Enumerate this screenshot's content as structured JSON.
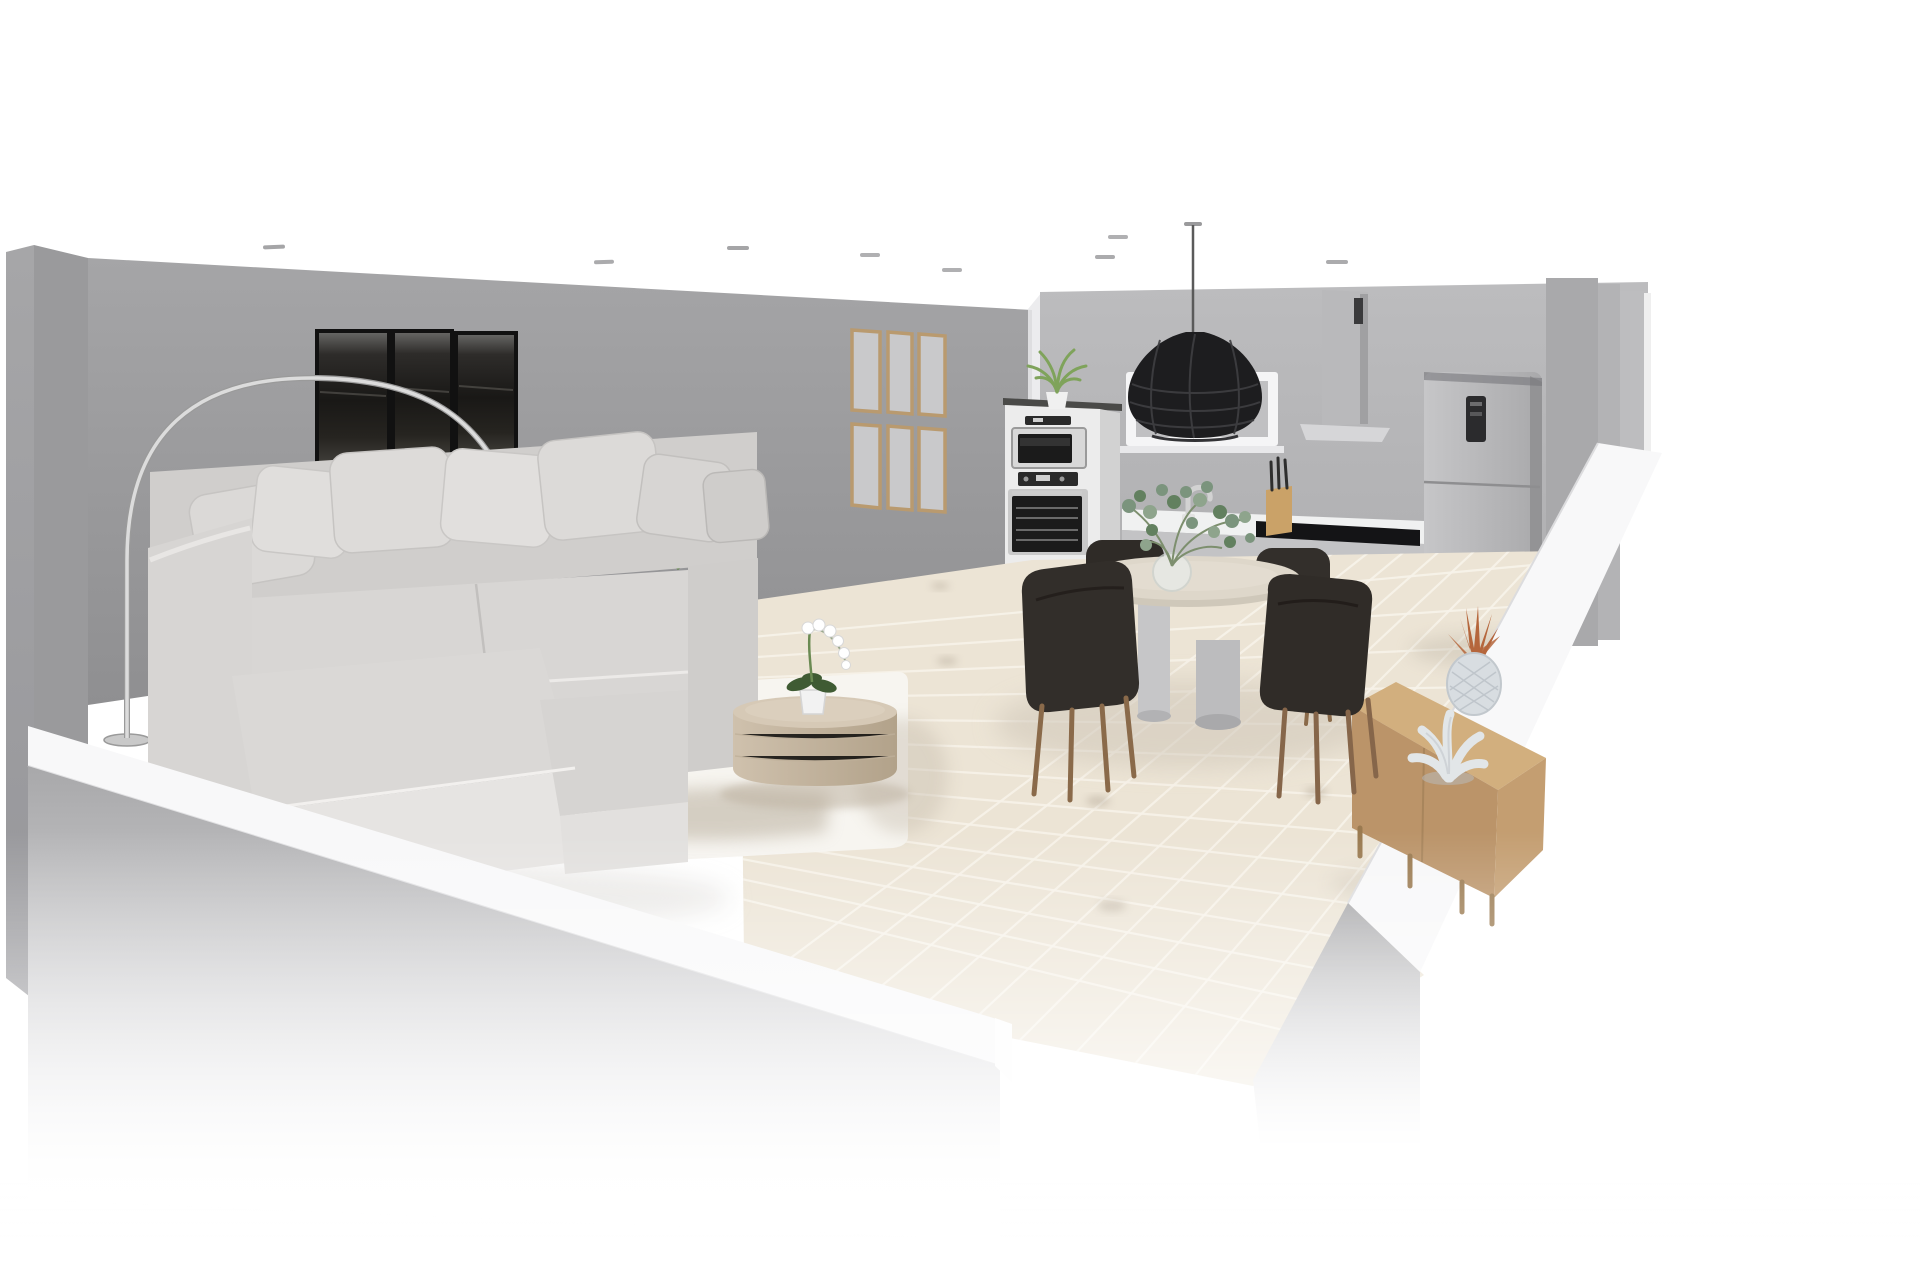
{
  "scene": {
    "type": "3d-interior-cutaway-render",
    "description": "Cutaway 3D rendering of an open-plan living room and kitchen-dining area, viewed from an elevated front-left angle. Gray walls, beige tiled floor, white fog fade at the bottom edges, and recessed ceiling spotlights.",
    "rooms": [
      {
        "name": "living-room",
        "objects": [
          "sectional-sofa",
          "throw-pillows",
          "arc-floor-lamp",
          "triptych-wall-art",
          "palm-plant",
          "area-rug",
          "round-coffee-table",
          "potted-orchid"
        ]
      },
      {
        "name": "kitchen-dining",
        "objects": [
          "gallery-frame-grid",
          "wall-window-frame",
          "wicker-pendant-lamp",
          "tall-oven-cabinet",
          "microwave",
          "oven",
          "cabinet-top-plant",
          "kitchen-counter",
          "cooktop",
          "faucet",
          "knife-block",
          "range-hood",
          "fridge-freezer",
          "round-dining-table",
          "dining-chairs",
          "eucalyptus-centerpiece",
          "wood-sideboard",
          "pineapple-ornament",
          "coral-ornament"
        ]
      }
    ],
    "lighting": {
      "ceiling_spotlights": 8,
      "pendant_over_dining": 1,
      "arc_lamp": 1
    }
  },
  "counts": {
    "dining_chairs": 4,
    "art_panels": 3,
    "gallery_frames": 6,
    "sofa_pillows": 7
  },
  "colors": {
    "background": "#ffffff",
    "wall_left": "#a0a0a2",
    "wall_back_top": "#a5a5a7",
    "wall_back_bottom": "#8f8f91",
    "wall_kitchen_top": "#bcbcbe",
    "wall_kitchen_bottom": "#a2a2a4",
    "wall_cut_white": "#f8f8f9",
    "floor_tile": "#ece4d5",
    "grout": "#f8f3ea",
    "rug": "#f7f5f0",
    "rug_shadow": "#b3a896",
    "sofa_body": "#d5d3d1",
    "sofa_light": "#e2e0de",
    "pillow": "#dbd9d7",
    "art_frame": "#111111",
    "gallery_frame_wood": "#b99a6f",
    "coffee_table_top": "#d6c9b6",
    "coffee_table_side": "#c4b59f",
    "dining_table_top": "#ded7ca",
    "dining_table_edge": "#cfc8ba",
    "pedestal_gray": "#c6c6c8",
    "chair_dark": "#322e2a",
    "chair_leg_wood": "#8a6a4a",
    "pendant_black": "#1d1d1f",
    "cord_gray": "#5a5a5a",
    "oven_cabinet": "#ececec",
    "appliance_dark": "#1b1b1b",
    "appliance_silver": "#d8d8d8",
    "countertop": "#f0f1f1",
    "counter_front": "#c3c3c5",
    "cooktop_black": "#141416",
    "knife_block_wood": "#caa268",
    "hood_gray": "#b9b9bb",
    "fridge_gray": "#b7b7b9",
    "sideboard_top": "#d2af7e",
    "sideboard_front": "#bb9469",
    "pineapple_body": "#d8dde1",
    "pineapple_leaves": "#b5663c",
    "coral_white": "#e2e6e8",
    "plant_green": "#6d9a4f",
    "plant_green_dark": "#557f3a",
    "eucalyptus_green": "#7b947d",
    "orchid_white": "#ffffff",
    "lamp_metal": "#dcdcdc",
    "spotlight_gray": "#8f8f91",
    "shadow_soft": "#cfc6b8"
  },
  "objects": {
    "sofa": {
      "label": "Light gray sectional sofa with chaise and throw pillows"
    },
    "arc_lamp": {
      "label": "Chrome arc floor lamp with glass globe shade"
    },
    "art": {
      "label": "Three-panel dark abstract wall art"
    },
    "gallery": {
      "label": "Grid of six empty wooden picture frames"
    },
    "palm": {
      "label": "Green palm houseplant behind sofa"
    },
    "rug": {
      "label": "White area rug"
    },
    "coffee_table": {
      "label": "Round wooden drum coffee table"
    },
    "orchid": {
      "label": "White orchid in a pot"
    },
    "pendant": {
      "label": "Black woven pendant lamp over dining table"
    },
    "window": {
      "label": "White wall frame / window above counter"
    },
    "oven_column": {
      "label": "Tall cabinet with built-in microwave and oven"
    },
    "cabinet_plant": {
      "label": "Small plant on top of oven cabinet"
    },
    "counter": {
      "label": "Kitchen counter with sink and cooktop"
    },
    "faucet": {
      "label": "Kitchen faucet"
    },
    "knife_block": {
      "label": "Wooden knife block"
    },
    "cooktop": {
      "label": "Black cooktop"
    },
    "hood": {
      "label": "Chimney range hood"
    },
    "fridge": {
      "label": "Gray fridge-freezer with display"
    },
    "dining_table": {
      "label": "Round pedestal dining table"
    },
    "chair": {
      "label": "Dark upholstered dining chair with wood legs"
    },
    "eucalyptus": {
      "label": "Eucalyptus branches in glass vase"
    },
    "sideboard": {
      "label": "Light wood sideboard"
    },
    "pineapple": {
      "label": "Ceramic pineapple ornament with copper leaves"
    },
    "coral": {
      "label": "White coral ornament"
    },
    "spotlight": {
      "label": "Recessed ceiling spotlight"
    },
    "floor": {
      "label": "Beige tiled floor"
    },
    "walls": {
      "label": "Gray wall"
    }
  }
}
